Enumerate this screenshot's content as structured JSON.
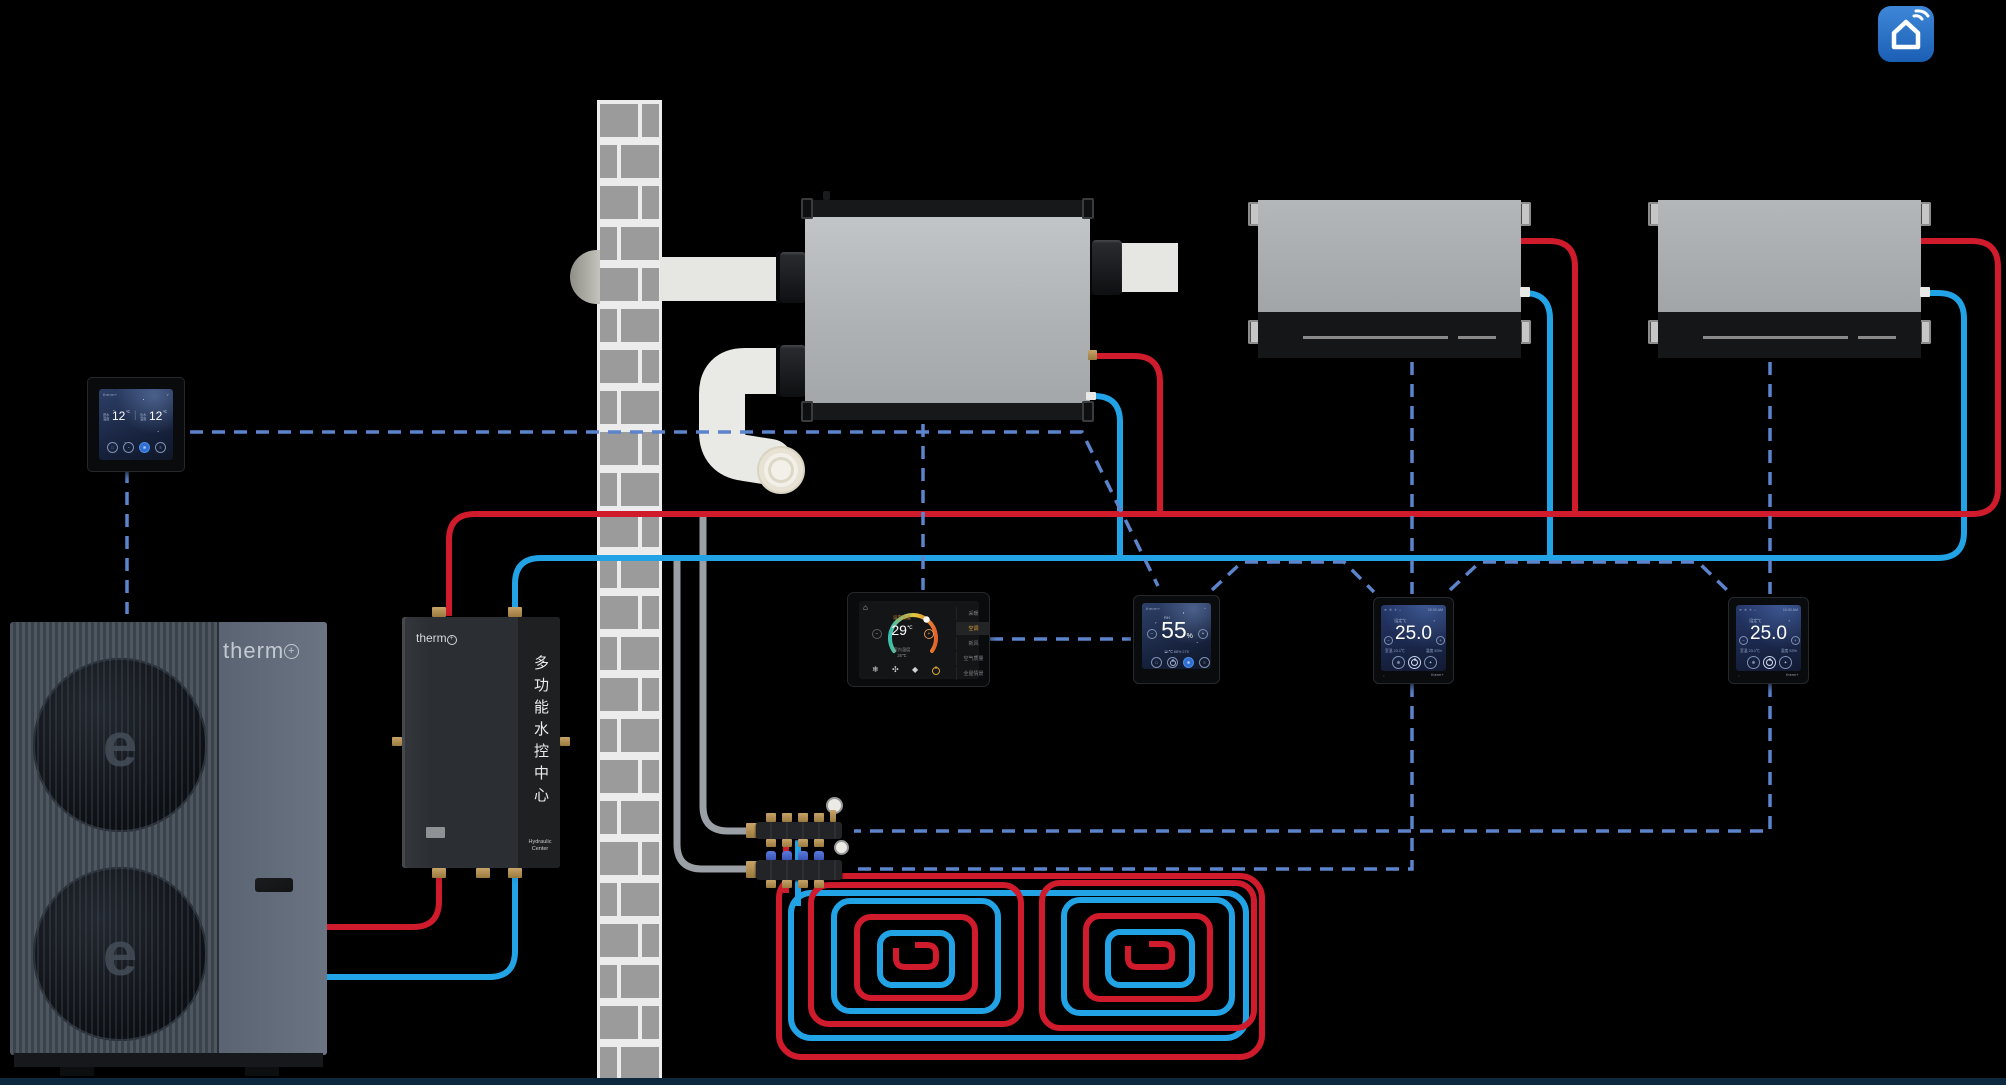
{
  "page": {
    "footer_note": ""
  },
  "colors": {
    "hot_pipe": "#cf1b2b",
    "cold_pipe": "#22a3e6",
    "control_line": "#5b84cc",
    "insulated_pipe": "#9aa0a6",
    "app_blue": "#2f7ad1"
  },
  "app_icon": {
    "label": "smart-home"
  },
  "heat_pump": {
    "brand": "therm",
    "brand_plus": "+",
    "fan_mark": "e"
  },
  "hydraulic_center": {
    "brand": "therm",
    "brand_plus": "+",
    "vertical_label": "多功能水控中心",
    "sub_line1": "Hydraulic",
    "sub_line2": "Center"
  },
  "wall_panel": {
    "brand": "therm+",
    "chevron": "∨",
    "left": {
      "label1": "进水",
      "label2": "温度",
      "value": "12",
      "unit": "℃"
    },
    "divider": "|",
    "right": {
      "label1": "出水",
      "label2": "温度",
      "value": "12",
      "unit": "℃"
    },
    "icon_lock": "□",
    "icon_clock": "◔",
    "icon_fan": "❋",
    "icon_menu": "≡"
  },
  "main_thermostat": {
    "home_icon": "⌂",
    "set_label": "设定温度",
    "value": "29",
    "unit": "℃",
    "minus": "−",
    "plus": "+",
    "room_label": "室内温度",
    "room_value": "25℃",
    "mode_snow": "❄",
    "mode_fan": "✣",
    "mode_drop": "◆",
    "menu": [
      "采暖",
      "空调",
      "新风",
      "空气质量",
      "全屋情景"
    ]
  },
  "humidity_panel": {
    "brand": "therm+",
    "chevron": "⌄",
    "metric": "RH",
    "value": "55",
    "unit": "%",
    "minus": "−",
    "plus": "+",
    "aux": "25℃   88%   275",
    "icon_lock": "□",
    "icon_fan": "❋",
    "icon_menu": "≡"
  },
  "room_thermostat_1": {
    "status_icons": "≋ ❄ ☀ ⌂",
    "time": "10:30 AM",
    "set_label": "设定℃",
    "lock": "▪",
    "value": "25.0",
    "minus": "−",
    "plus": "+",
    "room": "室温 23.1℃",
    "humidity": "湿度 53%",
    "icon_fan": "❋",
    "icon_mode": "✦",
    "corner": "▫",
    "brand": "therm+"
  },
  "room_thermostat_2": {
    "status_icons": "≋ ❄ ☀ ⌂",
    "time": "10:30 AM",
    "set_label": "设定℃",
    "lock": "▪",
    "value": "25.0",
    "minus": "−",
    "plus": "+",
    "room": "室温 23.1℃",
    "humidity": "湿度 53%",
    "icon_fan": "❋",
    "icon_mode": "✦",
    "corner": "▫",
    "brand": "therm+"
  }
}
